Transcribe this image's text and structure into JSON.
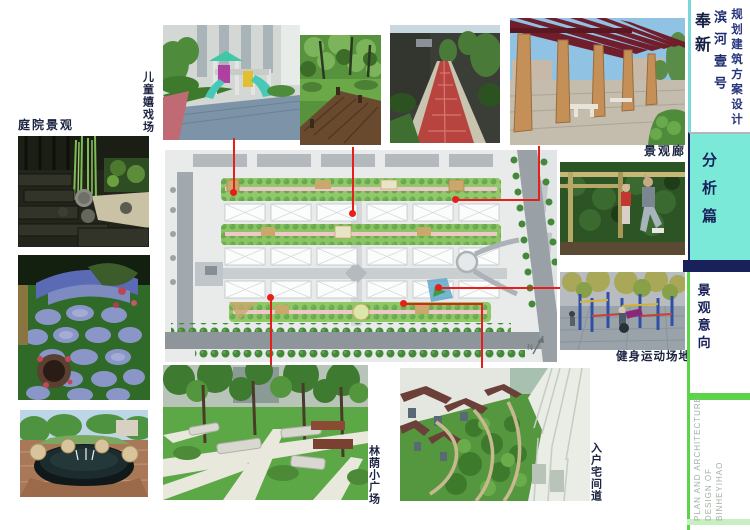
{
  "board": {
    "title_block": {
      "location": "奉新",
      "project": "滨河壹号",
      "subtitle": "规划建筑方案设计"
    },
    "section_tab": "分析篇",
    "chapter_tab": "景观意向",
    "footer_lines": [
      "PLAN AND ARCHITECTURE",
      "DESIGN OF",
      "BINHEYIHAO"
    ],
    "labels": {
      "courtyard": "庭院景观",
      "children_playground": "儿童嬉戏场",
      "landscape_corridor": "景观廊",
      "fitness_ground": "健身运动场地",
      "shaded_plaza": "林荫小广场",
      "entry_lane": "入户宅间道"
    },
    "plan": {
      "north_label": "N"
    },
    "colors": {
      "teal_tab": "#7be9d8",
      "navy": "#18215a",
      "bright_green": "#5cd44a",
      "pale_green": "#c6f0bf",
      "red_connector": "#e5201b",
      "plan_background": "#e9ebea",
      "label_text": "#1b2340"
    }
  }
}
